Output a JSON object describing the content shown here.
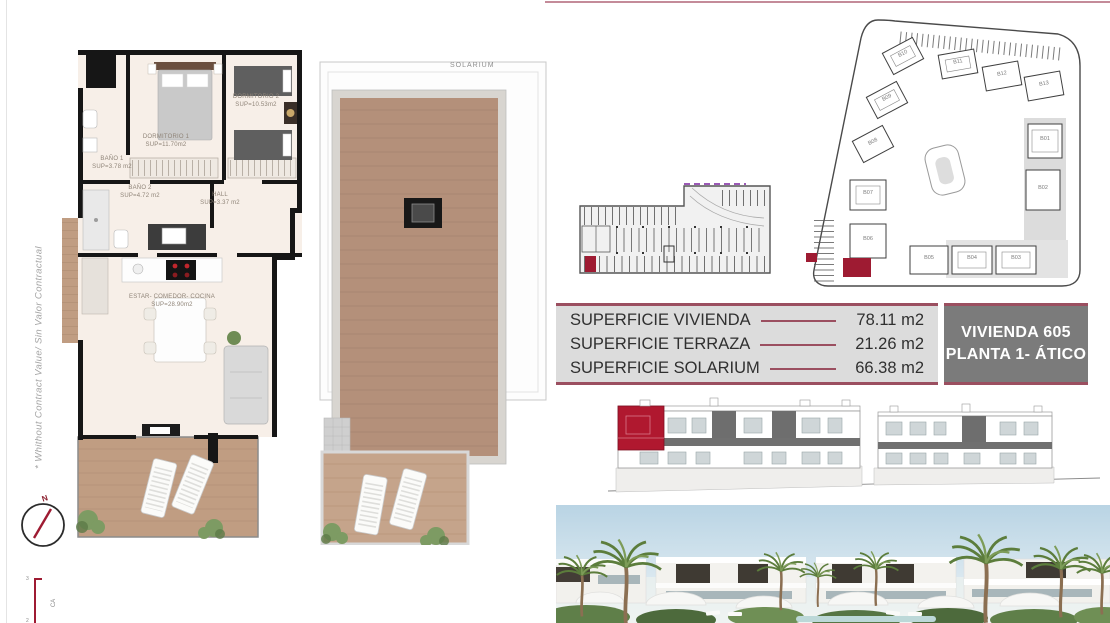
{
  "disclaimer": {
    "text": "* Whithout Contract Value/ Sin Valor Contractual"
  },
  "floor_plan": {
    "rooms": [
      {
        "name": "DORMITORIO 1",
        "area": "SUP=11.70m2"
      },
      {
        "name": "DORMITORIO 2",
        "area": "SUP=10.53m2"
      },
      {
        "name": "BAÑO 1",
        "area": "SUP=3.78 m2"
      },
      {
        "name": "BAÑO 2",
        "area": "SUP=4.72 m2"
      },
      {
        "name": "HALL",
        "area": "SUP=3.37 m2"
      },
      {
        "name": "ESTAR- COMEDOR- COCINA",
        "area": "SUP=28.90m2"
      }
    ]
  },
  "solarium_plan": {
    "label": "SOLARIUM"
  },
  "site_plan": {
    "buildings": [
      {
        "label": "B01"
      },
      {
        "label": "B02"
      },
      {
        "label": "B03"
      },
      {
        "label": "B04"
      },
      {
        "label": "B05"
      },
      {
        "label": "B06"
      },
      {
        "label": "B07"
      },
      {
        "label": "B08"
      },
      {
        "label": "B09"
      },
      {
        "label": "B10"
      },
      {
        "label": "B11"
      },
      {
        "label": "B12"
      },
      {
        "label": "B13"
      }
    ]
  },
  "surface_table": {
    "rows": [
      {
        "label": "SUPERFICIE VIVIENDA",
        "value": "78.11 m2"
      },
      {
        "label": "SUPERFICIE TERRAZA",
        "value": "21.26 m2"
      },
      {
        "label": "SUPERFICIE SOLARIUM",
        "value": "66.38 m2"
      }
    ],
    "unit": {
      "line1": "VIVIENDA 605",
      "line2": "PLANTA 1- ÁTICO"
    }
  },
  "compass": {
    "north_label": "N"
  },
  "scale_bar": {
    "top": "3",
    "bottom": "2",
    "caption": "CA"
  },
  "colors": {
    "accent_red": "#9e1b32",
    "table_border": "#9b4f60",
    "table_bg": "#dcdcdc",
    "unit_box_bg": "#7b7b7b",
    "top_rule": "#c48b99",
    "wood": "#bf9b81"
  }
}
